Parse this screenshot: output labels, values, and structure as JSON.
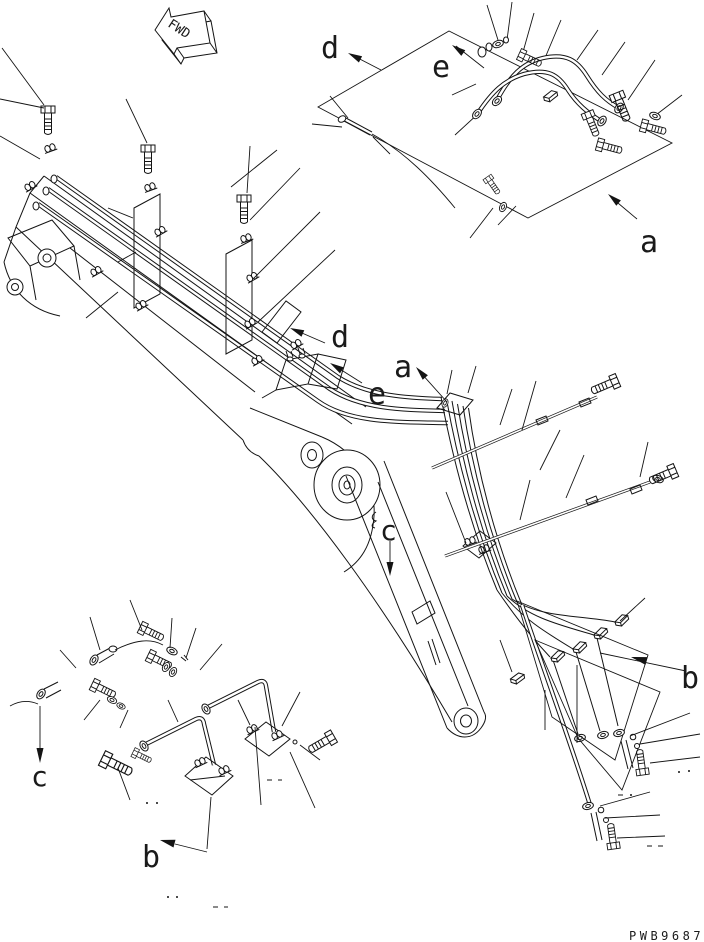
{
  "figure": {
    "drawing_number": "PWB9687",
    "fwd_label": "FWD"
  },
  "view_labels": {
    "a_top": "a",
    "a_mid": "a",
    "b_right": "b",
    "b_bottom": "b",
    "c_mid": "c",
    "c_bottom": "c",
    "d_top": "d",
    "d_mid": "d",
    "e_top": "e",
    "e_mid": "e"
  },
  "colors": {
    "line": "#141414",
    "background": "#ffffff"
  }
}
